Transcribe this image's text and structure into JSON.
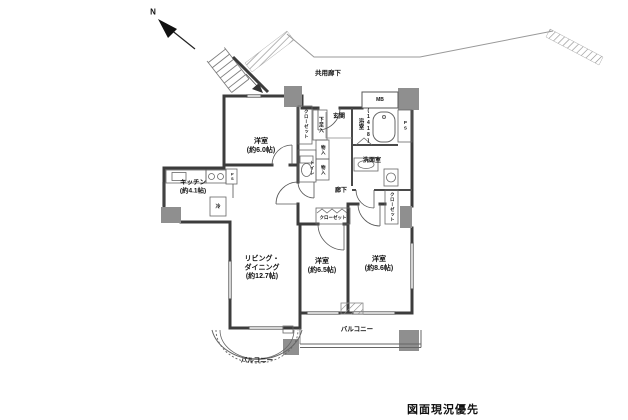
{
  "colors": {
    "wall": "#3c3c3c",
    "pillar": "#8f8f8f",
    "thin_line": "#777777",
    "text": "#111111"
  },
  "compass": {
    "north_label": "N"
  },
  "exterior": {
    "common_corridor": "共用廊下"
  },
  "rooms": {
    "western1": {
      "name": "洋室",
      "size": "(約6.0帖)"
    },
    "western2": {
      "name": "洋室",
      "size": "(約6.5帖)"
    },
    "western3": {
      "name": "洋室",
      "size": "(約8.6帖)"
    },
    "living_dining": {
      "name_line1": "リビング・",
      "name_line2": "ダイニング",
      "size": "(約12.7帖)"
    },
    "kitchen": {
      "name": "キッチン",
      "size": "(約4.1帖)"
    },
    "bath": {
      "name": "浴室",
      "size": "(1418)"
    },
    "washroom": {
      "name": "洗面室"
    },
    "toilet": {
      "name": "トイレ"
    },
    "hallway": {
      "name": "廊下"
    },
    "entrance": {
      "name": "玄関"
    }
  },
  "storage": {
    "closet_bedroom1": "クローゼット",
    "shoe_cabinet": "下足入",
    "storage_upper": "物入",
    "storage_lower": "物入",
    "closet_bedroom2": "クローゼット",
    "closet_bedroom3": "クローゼット"
  },
  "utilities": {
    "ps_kitchen": "PS",
    "ps_bath": "PS",
    "meter_box": "MB",
    "refrigerator": "冷"
  },
  "balconies": {
    "south": "バルコニー",
    "curved": "バルコニー"
  },
  "notes": {
    "priority_note": "図面現況優先"
  }
}
